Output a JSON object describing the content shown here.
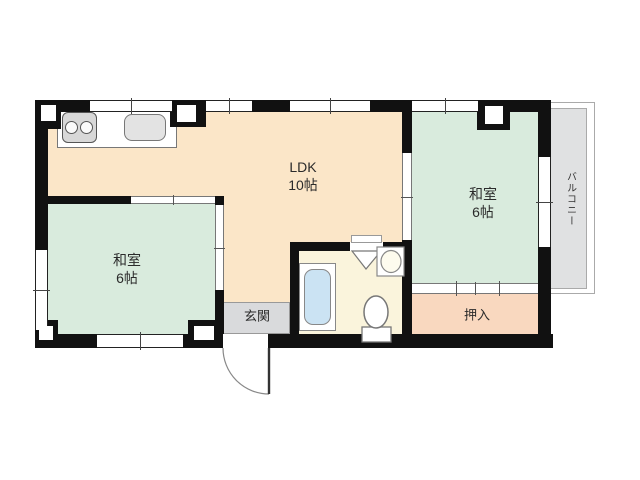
{
  "plan": {
    "rooms": {
      "ldk": {
        "label": "LDK",
        "size": "10帖"
      },
      "washitsu_left": {
        "label": "和室",
        "size": "6帖"
      },
      "washitsu_right": {
        "label": "和室",
        "size": "6帖"
      },
      "oshiire": {
        "label": "押入"
      },
      "genkan": {
        "label": "玄関"
      },
      "balcony": {
        "label": "バルコニー"
      }
    },
    "colors": {
      "ldk": "#fbe6c8",
      "washitsu": "#d9ebdd",
      "oshiire": "#f9d8bf",
      "genkan": "#d9dadc",
      "bathroom": "#faf4dc",
      "balcony": "#e0e1e2",
      "wall": "#111111",
      "tub": "#cbe3f3"
    },
    "fixtures": [
      "stove-icon",
      "kitchen-sink-icon",
      "bathtub-icon",
      "toilet-icon",
      "washbasin-icon",
      "bath-door-icon",
      "entry-door-swing-icon"
    ]
  }
}
